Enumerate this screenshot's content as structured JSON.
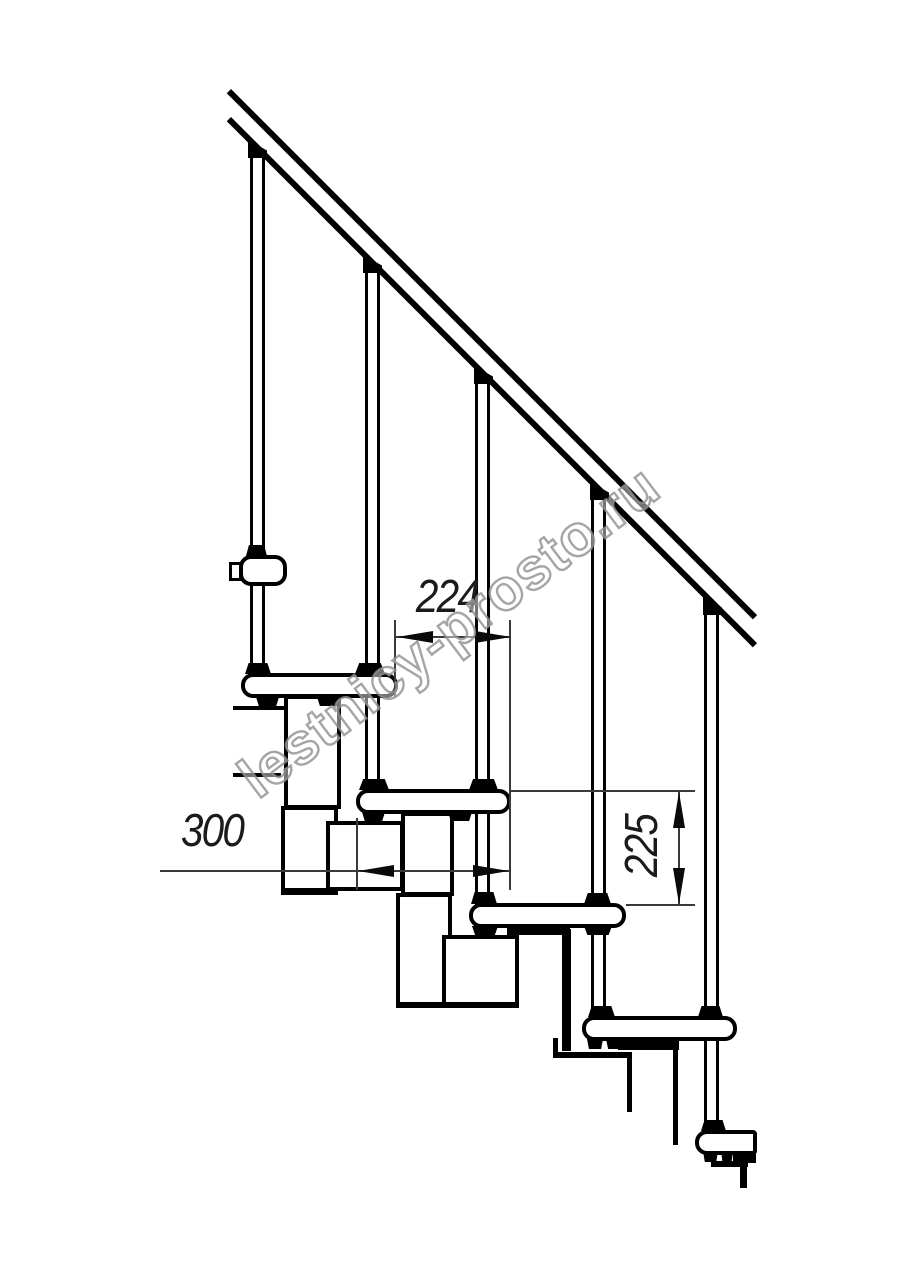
{
  "drawing": {
    "type": "staircase-side-elevation-technical-drawing",
    "background": "#ffffff",
    "line_color": "#000000",
    "dimension_color": "#3a3a3a",
    "dimensions": {
      "step_run": {
        "label": "224",
        "orientation": "horizontal"
      },
      "tread_depth": {
        "label": "300",
        "orientation": "horizontal"
      },
      "riser_height": {
        "label": "225",
        "orientation": "vertical"
      }
    },
    "watermark": {
      "text": "lestnicy-prosto.ru",
      "color": "#8f8f8f"
    }
  }
}
